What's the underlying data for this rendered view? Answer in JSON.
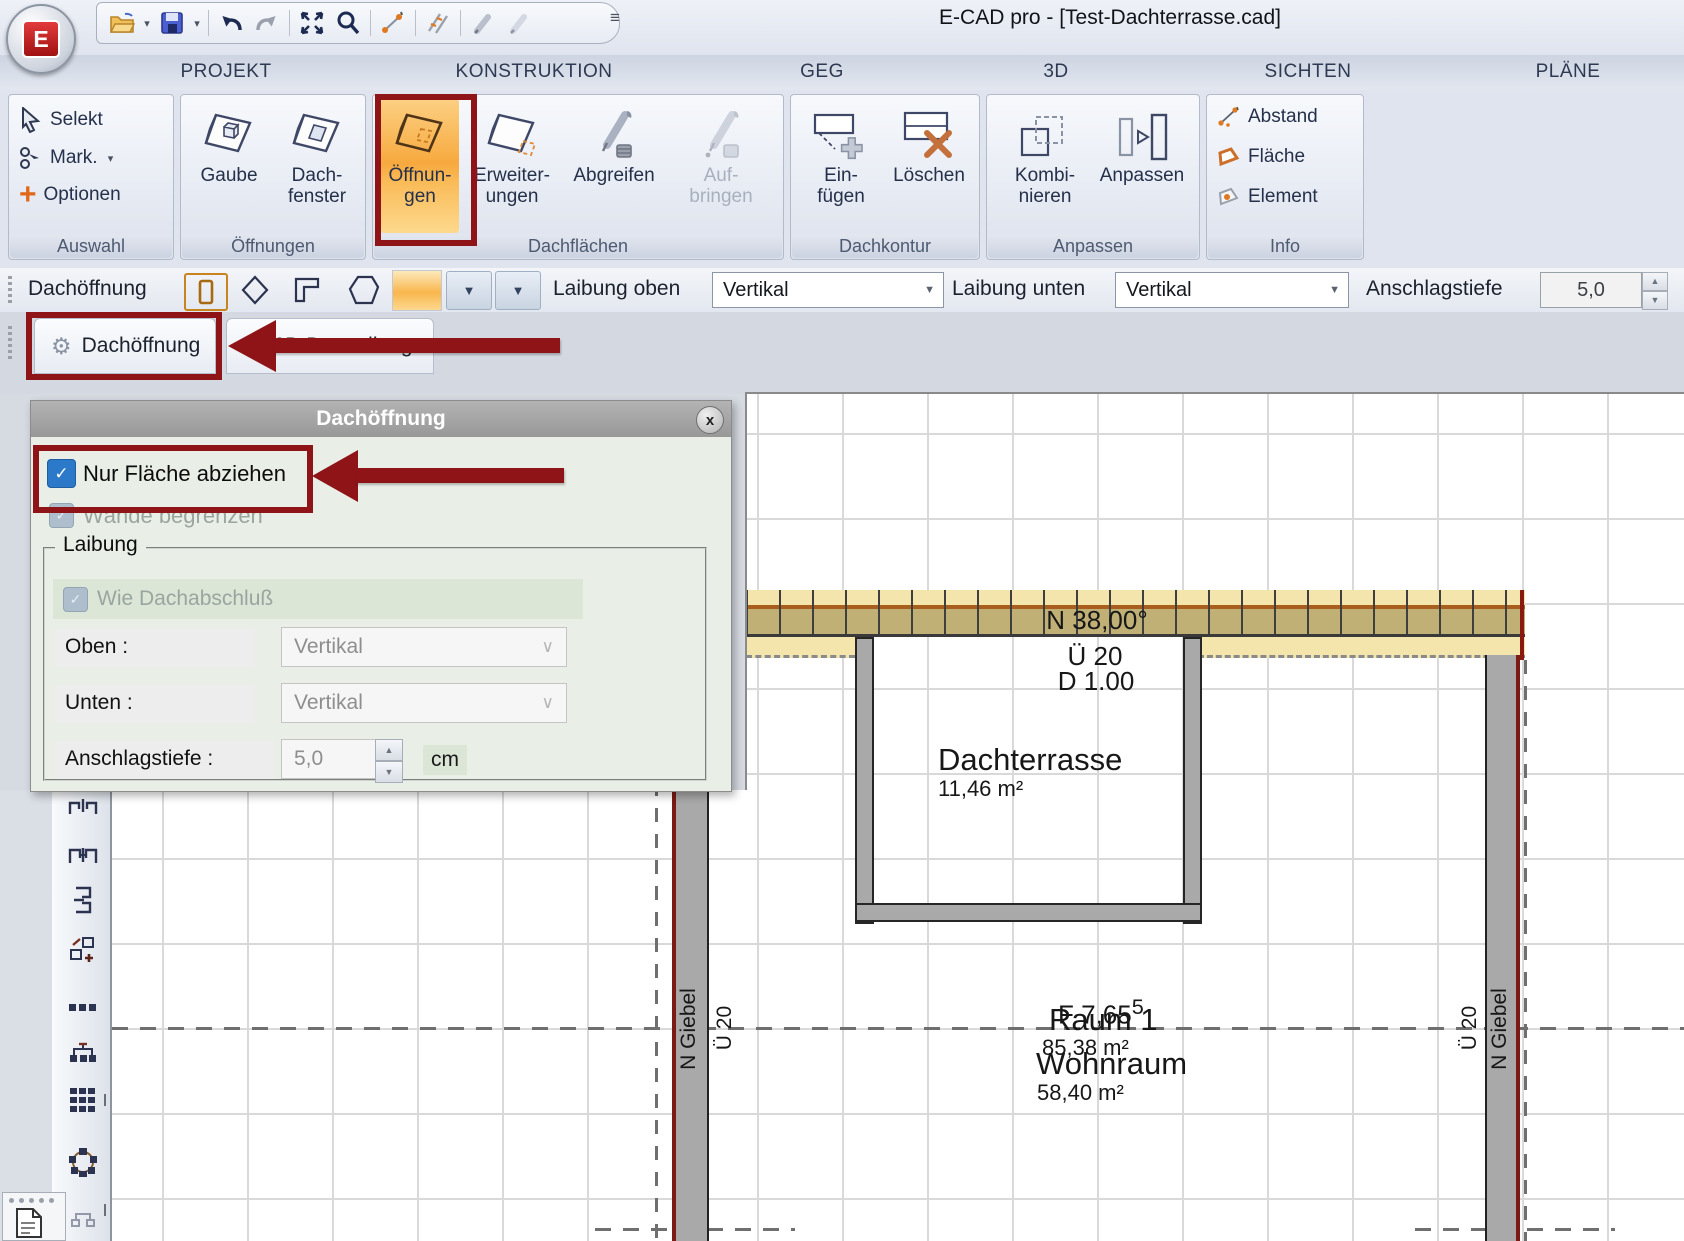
{
  "app": {
    "title": "E-CAD pro - [Test-Dachterrasse.cad]",
    "logo_letter": "E"
  },
  "glyphs": {
    "check": "✓",
    "caret_down": "▼",
    "chevron_down": "∨",
    "spin_up": "▲",
    "spin_down": "▼",
    "gear": "⚙",
    "close": "x",
    "menu": "≡",
    "plus": "+",
    "cross": "✗",
    "drop_small": "▾"
  },
  "quick_access": {
    "icons": [
      "open-file",
      "save",
      "undo",
      "redo",
      "zoom-extents",
      "zoom",
      "measure",
      "parallel-copy",
      "pick-style",
      "apply-style"
    ]
  },
  "ribbon": {
    "tabs": [
      {
        "label": "PROJEKT"
      },
      {
        "label": "KONSTRUKTION"
      },
      {
        "label": "GEG"
      },
      {
        "label": "3D"
      },
      {
        "label": "SICHTEN"
      },
      {
        "label": "PLÄNE"
      }
    ],
    "auswahl": {
      "title": "Auswahl",
      "items": [
        {
          "label": "Selekt"
        },
        {
          "label": "Mark."
        },
        {
          "label": "Optionen"
        }
      ]
    },
    "groups": [
      {
        "title": "Öffnungen",
        "buttons": [
          {
            "line1": "Gaube",
            "line2": ""
          },
          {
            "line1": "Dach-",
            "line2": "fenster"
          }
        ]
      },
      {
        "title": "Dachflächen",
        "buttons": [
          {
            "line1": "Öffnun-",
            "line2": "gen"
          },
          {
            "line1": "Erweiter-",
            "line2": "ungen"
          },
          {
            "line1": "Abgreifen",
            "line2": ""
          },
          {
            "line1": "Auf-",
            "line2": "bringen"
          }
        ]
      },
      {
        "title": "Dachkontur",
        "buttons": [
          {
            "line1": "Ein-",
            "line2": "fügen"
          },
          {
            "line1": "Löschen",
            "line2": ""
          }
        ]
      },
      {
        "title": "Anpassen",
        "buttons": [
          {
            "line1": "Kombi-",
            "line2": "nieren"
          },
          {
            "line1": "Anpassen",
            "line2": ""
          }
        ]
      },
      {
        "title": "Info",
        "items": [
          {
            "label": "Abstand"
          },
          {
            "label": "Fläche"
          },
          {
            "label": "Element"
          }
        ]
      }
    ]
  },
  "toolbar": {
    "title": "Dachöffnung",
    "laibung_oben": {
      "label": "Laibung oben",
      "value": "Vertikal"
    },
    "laibung_unten": {
      "label": "Laibung unten",
      "value": "Vertikal"
    },
    "anschlagstiefe": {
      "label": "Anschlagstiefe",
      "value": "5,0"
    }
  },
  "view_tabs": [
    {
      "label": "Dachöffnung"
    },
    {
      "label": "2D Darstellung"
    }
  ],
  "side_toolbar": {
    "icons": [
      "opening-pair",
      "opening-pair-wide",
      "wall-bracket",
      "copy-add",
      "blocks-row",
      "blocks-linked",
      "blocks-grid",
      "circular-array",
      "connector"
    ]
  },
  "dialog": {
    "title": "Dachöffnung",
    "checkbox_flaeche": {
      "label": "Nur Fläche abziehen",
      "checked": true
    },
    "checkbox_waende": {
      "label": "Wände begrenzen",
      "checked": true,
      "disabled": true
    },
    "laibung_group": {
      "title": "Laibung",
      "checkbox_dachabschluss": {
        "label": "Wie Dachabschluß",
        "checked": true,
        "disabled": true
      },
      "oben": {
        "label": "Oben :",
        "value": "Vertikal"
      },
      "unten": {
        "label": "Unten :",
        "value": "Vertikal"
      },
      "anschlagstiefe": {
        "label": "Anschlagstiefe :",
        "value": "5,0",
        "unit": "cm"
      }
    }
  },
  "drawing": {
    "roof_angle": "N 38,00°",
    "overhang": "Ü 20",
    "thickness": "D 1.00",
    "terrace": {
      "name": "Dachterrasse",
      "area": "11,46 m²"
    },
    "dimension": {
      "prefix": "F 7,65",
      "sup": "5"
    },
    "room": {
      "name": "Raum 1",
      "area": "85,38 m²",
      "use": "Wohnraum",
      "use_area": "58,40 m²"
    },
    "gable_left": {
      "name": "N Giebel",
      "overhang": "Ü 20"
    },
    "gable_right": {
      "name": "N Giebel",
      "overhang": "Ü 20"
    }
  },
  "colors": {
    "annotation": "#8e1418",
    "checkbox_blue": "#2b79c8",
    "roof_light": "#f4e5ad",
    "roof_dark": "#c0b076",
    "highlight_orange": "#f7a93e"
  }
}
